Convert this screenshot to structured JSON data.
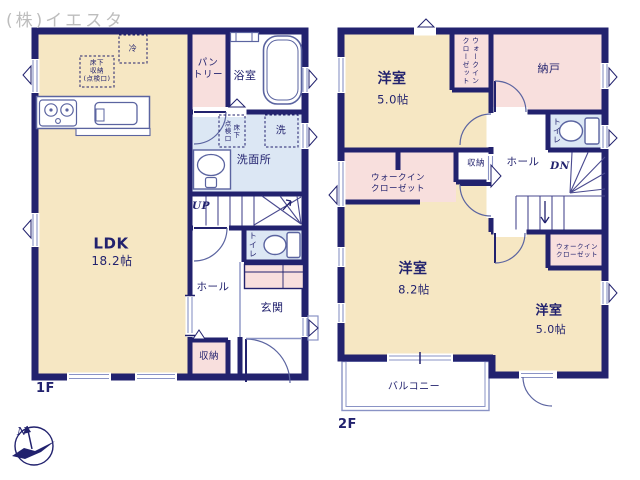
{
  "watermark": "(株)イエスタ",
  "palette": {
    "wall_navy": "#22226E",
    "room_cream": "#F6E7C3",
    "room_pink": "#F8DFDD",
    "room_blue": "#DCE7F4",
    "fixture_line": "#5B64A0",
    "window_line": "#8A93C5",
    "watermark_gray": "#BDBDBD"
  },
  "floor1": {
    "label": "1F",
    "ldk_name": "LDK",
    "ldk_size": "18.2帖",
    "fridge": "冷",
    "underfloor_storage": "床下\n収納\n(点検口)",
    "pantry": "パン\nトリー",
    "bathroom": "浴室",
    "underfloor_hatch": "床下\n点検口",
    "laundry": "洗",
    "washroom": "洗面所",
    "stairs_up": "UP",
    "toilet": "トイレ",
    "hall": "ホール",
    "entrance": "玄関",
    "storage": "収納"
  },
  "floor2": {
    "label": "2F",
    "room_a_name": "洋室",
    "room_a_size": "5.0帖",
    "wic_top": "ウォークイン\nクローゼット",
    "storeroom": "納戸",
    "toilet": "トイレ",
    "hall": "ホール",
    "stairs_down": "DN",
    "storage": "収納",
    "wic_mid": "ウォークイン\nクローゼット",
    "room_b_name": "洋室",
    "room_b_size": "8.2帖",
    "wic_br": "ウォークイン\nクローゼット",
    "room_c_name": "洋室",
    "room_c_size": "5.0帖",
    "balcony": "バルコニー"
  },
  "compass": {
    "north": "N"
  }
}
